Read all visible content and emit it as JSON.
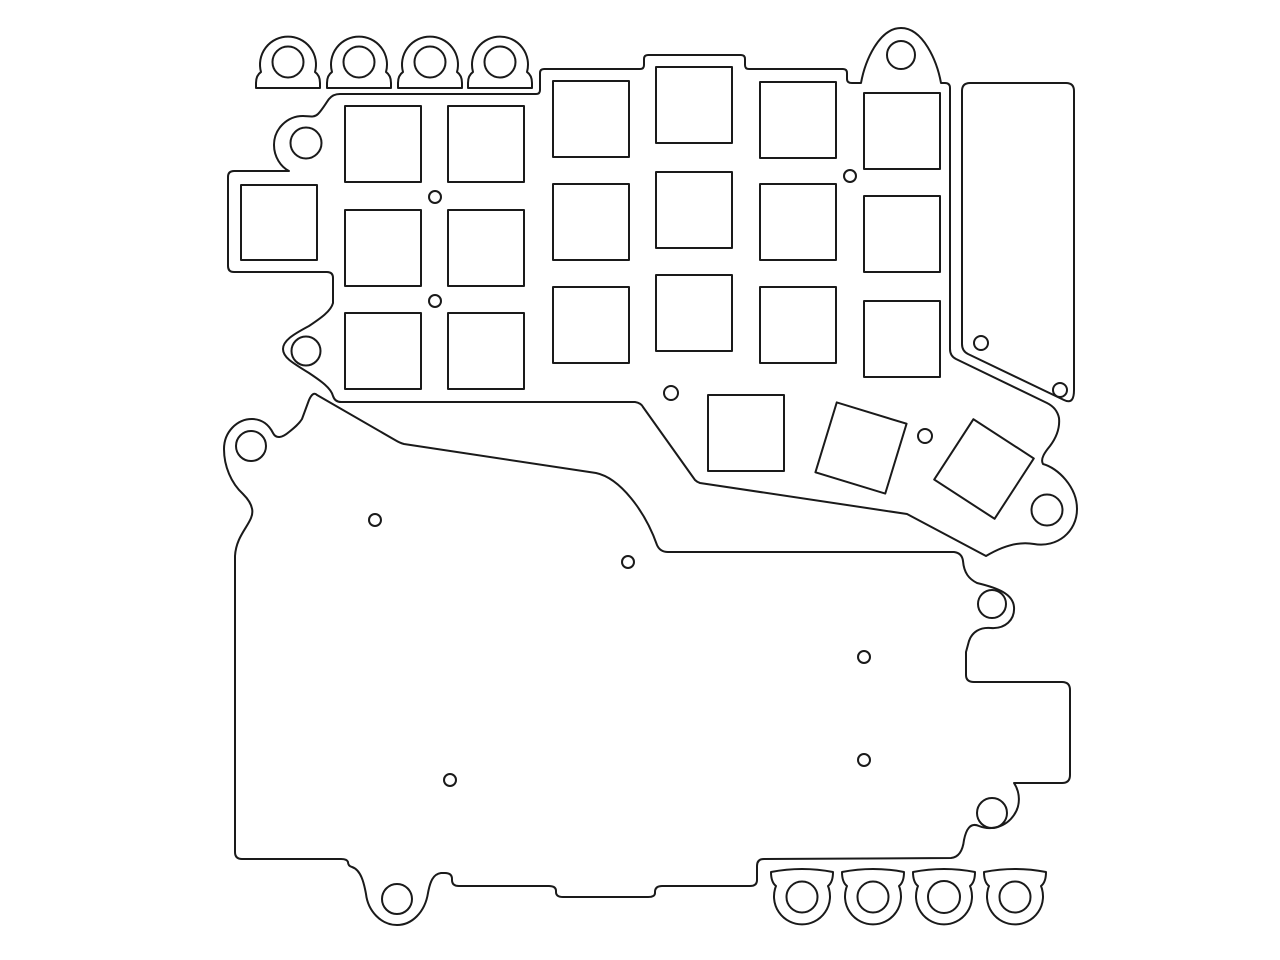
{
  "drawing": {
    "description": "black-and-white CAD outline drawing of laser-cut keyboard plates",
    "background": "#ffffff",
    "stroke_color": "#1a1a1a",
    "stroke_width": 2,
    "viewbox": "0 0 1280 960",
    "width": 1280,
    "height": 960,
    "elements": [
      {
        "name": "top-tab-1",
        "type": "path",
        "d": "M 256,88 L 256,83 C 256,78 258,74 261,72 A 28 28 0 1 1 315,72 C 318,74 320,78 320,83 L 320,88 Z"
      },
      {
        "name": "top-tab-1-hole",
        "type": "circle",
        "cx": 288,
        "cy": 62,
        "r": 15.5
      },
      {
        "name": "top-tab-2",
        "type": "path",
        "d": "M 327,88 L 327,83 C 327,78 329,74 332,72 A 28 28 0 1 1 386,72 C 389,74 391,78 391,83 L 391,88 Z"
      },
      {
        "name": "top-tab-2-hole",
        "type": "circle",
        "cx": 359,
        "cy": 62,
        "r": 15.5
      },
      {
        "name": "top-tab-3",
        "type": "path",
        "d": "M 398,88 L 398,83 C 398,78 400,74 403,72 A 28 28 0 1 1 457,72 C 460,74 462,78 462,83 L 462,88 Z"
      },
      {
        "name": "top-tab-3-hole",
        "type": "circle",
        "cx": 430,
        "cy": 62,
        "r": 15.5
      },
      {
        "name": "top-tab-4",
        "type": "path",
        "d": "M 468,88 L 468,83 C 468,78 470,74 473,72 A 28 28 0 1 1 527,72 C 530,74 532,78 532,83 L 532,88 Z"
      },
      {
        "name": "top-tab-4-hole",
        "type": "circle",
        "cx": 500,
        "cy": 62,
        "r": 15.5
      },
      {
        "name": "switch-plate-outline",
        "type": "path",
        "d": "M 340,94 L 536,94 Q 540,94 540,90 L 540,73 Q 540,69 544,69 L 640,69 Q 644,69 644,65 L 644,59 Q 644,55 648,55 L 741,55 Q 745,55 745,59 L 745,65 Q 745,69 749,69 L 843,69 Q 847,69 847,73 L 847,79 Q 847,83 852,83 L 861,83 C 865,61 879,28 901,28 C 923,28 937,61 941,83 L 945,83 Q 950,83 950,88 L 950,349 Q 950,356 956,359 L 1047,403 Q 1057,408 1059,418 C 1060,428 1056,438 1050,446 C 1045,452 1040,459 1043,464 C 1058,468 1077,487 1077,509 C 1077,532 1057,548 1034,544 C 1018,541 1001,547 986,556 L 907,514 L 700,483 Q 697,482 695,480 L 643,407 Q 641,403 635,402 L 341,402 Q 335,402 333,396 C 331,388 321,381 309,373 C 291,362 283,357 283,349 C 283,341 292,335 309,326 C 321,318 331,311 333,303 L 333,278 Q 333,272 327,272 L 234,272 Q 228,272 228,266 L 228,177 Q 228,171 234,171 L 289,171 C 281,167 274,157 274,145 C 274,129 287,116 303,116 C 309,116 314,118 318,114 C 322,110 326,103 329,99 Q 333,94 340,94 Z"
      },
      {
        "name": "switch-cutout-c1-r1",
        "type": "rect",
        "x": 345,
        "y": 106,
        "w": 76,
        "h": 76
      },
      {
        "name": "switch-cutout-c1-r2",
        "type": "rect",
        "x": 345,
        "y": 210,
        "w": 76,
        "h": 76
      },
      {
        "name": "switch-cutout-c1-r3",
        "type": "rect",
        "x": 345,
        "y": 313,
        "w": 76,
        "h": 76
      },
      {
        "name": "switch-cutout-c2-r1",
        "type": "rect",
        "x": 448,
        "y": 106,
        "w": 76,
        "h": 76
      },
      {
        "name": "switch-cutout-c2-r2",
        "type": "rect",
        "x": 448,
        "y": 210,
        "w": 76,
        "h": 76
      },
      {
        "name": "switch-cutout-c2-r3",
        "type": "rect",
        "x": 448,
        "y": 313,
        "w": 76,
        "h": 76
      },
      {
        "name": "switch-cutout-c3-r1",
        "type": "rect",
        "x": 553,
        "y": 81,
        "w": 76,
        "h": 76
      },
      {
        "name": "switch-cutout-c3-r2",
        "type": "rect",
        "x": 553,
        "y": 184,
        "w": 76,
        "h": 76
      },
      {
        "name": "switch-cutout-c3-r3",
        "type": "rect",
        "x": 553,
        "y": 287,
        "w": 76,
        "h": 76
      },
      {
        "name": "switch-cutout-c4-r1",
        "type": "rect",
        "x": 656,
        "y": 67,
        "w": 76,
        "h": 76
      },
      {
        "name": "switch-cutout-c4-r2",
        "type": "rect",
        "x": 656,
        "y": 172,
        "w": 76,
        "h": 76
      },
      {
        "name": "switch-cutout-c4-r3",
        "type": "rect",
        "x": 656,
        "y": 275,
        "w": 76,
        "h": 76
      },
      {
        "name": "switch-cutout-c5-r1",
        "type": "rect",
        "x": 760,
        "y": 82,
        "w": 76,
        "h": 76
      },
      {
        "name": "switch-cutout-c5-r2",
        "type": "rect",
        "x": 760,
        "y": 184,
        "w": 76,
        "h": 76
      },
      {
        "name": "switch-cutout-c5-r3",
        "type": "rect",
        "x": 760,
        "y": 287,
        "w": 76,
        "h": 76
      },
      {
        "name": "switch-cutout-c6-r1",
        "type": "rect",
        "x": 864,
        "y": 93,
        "w": 76,
        "h": 76
      },
      {
        "name": "switch-cutout-c6-r2",
        "type": "rect",
        "x": 864,
        "y": 196,
        "w": 76,
        "h": 76
      },
      {
        "name": "switch-cutout-c6-r3",
        "type": "rect",
        "x": 864,
        "y": 301,
        "w": 76,
        "h": 76
      },
      {
        "name": "side-extension-cutout",
        "type": "rect",
        "x": 241,
        "y": 185,
        "w": 76,
        "h": 75
      },
      {
        "name": "thumb-cutout-1",
        "type": "rect",
        "x": 708,
        "y": 395,
        "w": 76,
        "h": 76
      },
      {
        "name": "thumb-cutout-2",
        "type": "rect",
        "x": 824.5,
        "y": 411.5,
        "w": 73,
        "h": 73,
        "transform": "rotate(17 861 448)"
      },
      {
        "name": "thumb-cutout-3",
        "type": "rect",
        "x": 948,
        "y": 433,
        "w": 72,
        "h": 72,
        "transform": "rotate(33 984 469)"
      },
      {
        "name": "plate-ear-hole-left-top",
        "type": "circle",
        "cx": 306,
        "cy": 143,
        "r": 15.5
      },
      {
        "name": "plate-ear-hole-left-bottom",
        "type": "circle",
        "cx": 306,
        "cy": 351,
        "r": 14.5
      },
      {
        "name": "plate-ear-hole-top-right",
        "type": "circle",
        "cx": 901,
        "cy": 55,
        "r": 14
      },
      {
        "name": "plate-ear-hole-thumb",
        "type": "circle",
        "cx": 1047,
        "cy": 510,
        "r": 15.5
      },
      {
        "name": "plate-pin-hole-1",
        "type": "circle",
        "cx": 435,
        "cy": 197,
        "r": 6
      },
      {
        "name": "plate-pin-hole-2",
        "type": "circle",
        "cx": 435,
        "cy": 301,
        "r": 6
      },
      {
        "name": "plate-pin-hole-3",
        "type": "circle",
        "cx": 850,
        "cy": 176,
        "r": 6
      },
      {
        "name": "plate-pin-hole-4",
        "type": "circle",
        "cx": 671,
        "cy": 393,
        "r": 7
      },
      {
        "name": "plate-pin-hole-5",
        "type": "circle",
        "cx": 925,
        "cy": 436,
        "r": 7
      },
      {
        "name": "side-panel-outline",
        "type": "path",
        "d": "M 962,91 Q 962,83 970,83 L 1066,83 Q 1074,83 1074,91 L 1074,390 C 1074,398 1072,404 1064,400 L 968,354 Q 962,351 962,344 L 962,91 Z"
      },
      {
        "name": "side-panel-hole-1",
        "type": "circle",
        "cx": 981,
        "cy": 343,
        "r": 7
      },
      {
        "name": "side-panel-hole-2",
        "type": "circle",
        "cx": 1060,
        "cy": 390,
        "r": 7
      },
      {
        "name": "bottom-plate-outline",
        "type": "path",
        "d": "M 235,848 L 235,556 C 236,538 247,528 251,518 C 255,509 250,501 243,494 C 231,483 224,466 224,449 C 224,432 237,419 252,419 C 262,419 269,425 273,433 C 276,439 282,438 289,432 C 294,428 299,424 302,419 L 309,400 Q 313,391 317,395 L 395,440 Q 400,443 404,444 L 596,473 C 620,478 645,511 657,545 Q 660,552 668,552 L 954,552 Q 962,553 963,561 C 964,573 969,579 977,583 C 998,588 1013,594 1014,607 C 1015,620 1005,629 991,628 C 980,627 972,632 969,641 L 966,652 L 966,675 Q 966,682 974,682 L 1062,682 Q 1070,682 1070,690 L 1070,775 Q 1070,783 1062,783 L 1014,783 C 1020,792 1021,805 1014,815 C 1006,827 991,831 979,826 C 970,822 966,830 964,840 Q 962,857 951,858 L 764,859 Q 757,859 757,866 L 757,880 Q 757,886 750,886 L 662,886 Q 655,886 655,892 L 655,893 Q 655,897 648,897 L 563,897 Q 556,897 556,892 L 556,891 Q 556,886 549,886 L 459,886 Q 452,886 452,880 L 452,879 Q 452,873 445,873 L 441,873 C 433,874 430,882 428,893 C 425,912 412,925 397,925 C 381,925 368,911 366,894 C 364,883 361,870 352,867 Q 348,866 348,862 Q 347,859 341,859 L 242,859 Q 235,859 235,852 Z"
      },
      {
        "name": "bottom-plate-tab-hole-left",
        "type": "circle",
        "cx": 251,
        "cy": 446,
        "r": 15
      },
      {
        "name": "bottom-plate-ear-hole-right-top",
        "type": "circle",
        "cx": 992,
        "cy": 604,
        "r": 14
      },
      {
        "name": "bottom-plate-ear-hole-right-bottom",
        "type": "circle",
        "cx": 992,
        "cy": 813,
        "r": 15
      },
      {
        "name": "bottom-plate-tab-hole-bottom-left",
        "type": "circle",
        "cx": 397,
        "cy": 899,
        "r": 15
      },
      {
        "name": "bottom-plate-pin-hole-1",
        "type": "circle",
        "cx": 375,
        "cy": 520,
        "r": 6
      },
      {
        "name": "bottom-plate-pin-hole-2",
        "type": "circle",
        "cx": 628,
        "cy": 562,
        "r": 6
      },
      {
        "name": "bottom-plate-pin-hole-3",
        "type": "circle",
        "cx": 864,
        "cy": 657,
        "r": 6
      },
      {
        "name": "bottom-plate-pin-hole-4",
        "type": "circle",
        "cx": 864,
        "cy": 760,
        "r": 6
      },
      {
        "name": "bottom-plate-pin-hole-5",
        "type": "circle",
        "cx": 450,
        "cy": 780,
        "r": 6
      },
      {
        "name": "bottom-tab-1",
        "type": "path",
        "d": "M 771,872 Q 802,866 833,872 C 833,878 832,883 828,886 A 28 28 0 1 1 776,886 C 772,883 771,878 771,872 Z"
      },
      {
        "name": "bottom-tab-1-hole",
        "type": "circle",
        "cx": 802,
        "cy": 897,
        "r": 15.5
      },
      {
        "name": "bottom-tab-2",
        "type": "path",
        "d": "M 842,872 Q 873,866 904,872 C 904,878 903,883 899,886 A 28 28 0 1 1 847,886 C 843,883 842,878 842,872 Z"
      },
      {
        "name": "bottom-tab-2-hole",
        "type": "circle",
        "cx": 873,
        "cy": 897,
        "r": 15.5
      },
      {
        "name": "bottom-tab-3",
        "type": "path",
        "d": "M 913,872 Q 944,866 975,872 C 975,878 974,883 970,886 A 28 28 0 1 1 918,886 C 914,883 913,878 913,872 Z"
      },
      {
        "name": "bottom-tab-3-hole",
        "type": "circle",
        "cx": 944,
        "cy": 897,
        "r": 16
      },
      {
        "name": "bottom-tab-4",
        "type": "path",
        "d": "M 984,872 Q 1015,866 1046,872 C 1046,878 1045,883 1041,886 A 28 28 0 1 1 989,886 C 985,883 984,878 984,872 Z"
      },
      {
        "name": "bottom-tab-4-hole",
        "type": "circle",
        "cx": 1015,
        "cy": 897,
        "r": 15.5
      }
    ]
  }
}
